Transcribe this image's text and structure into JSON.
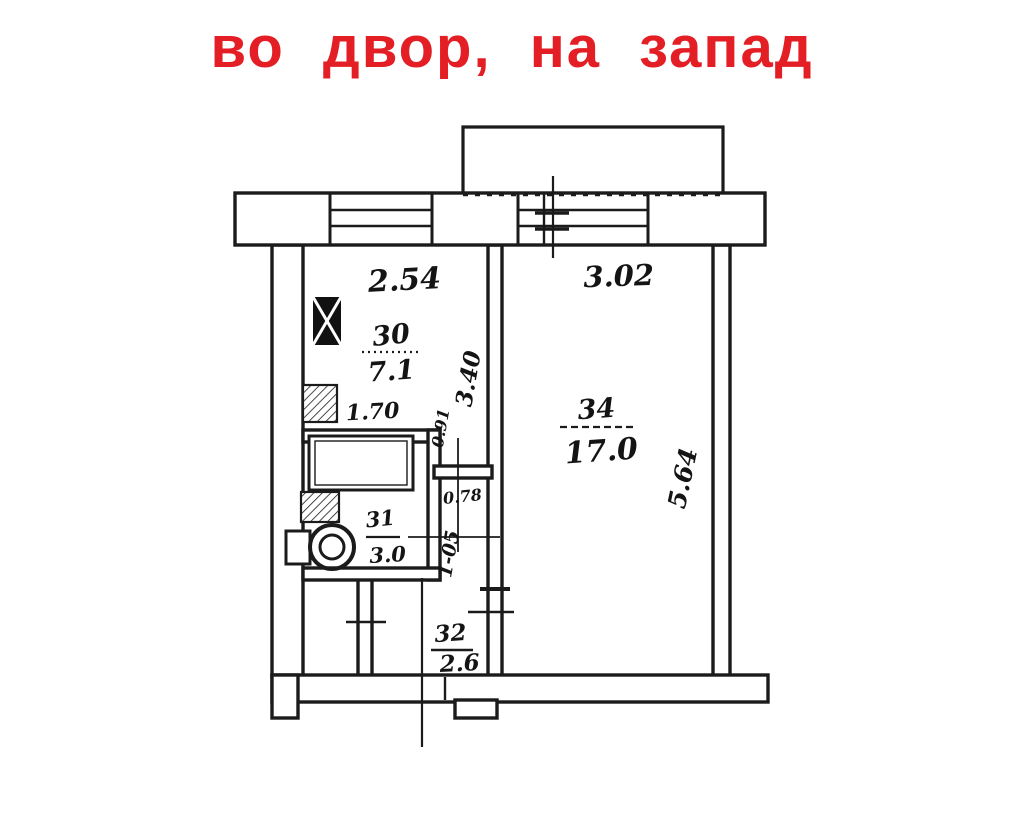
{
  "title": {
    "text": "во двор, на запад",
    "color": "#e31e24"
  },
  "plan": {
    "rooms": [
      {
        "id": "kitchen",
        "number": "30",
        "area": "7.1"
      },
      {
        "id": "bathroom",
        "number": "31",
        "area": "3.0"
      },
      {
        "id": "hall",
        "number": "32",
        "area": "2.6"
      },
      {
        "id": "living-room",
        "number": "34",
        "area": "17.0"
      }
    ],
    "dimensions": {
      "kitchen_width": "2.54",
      "living_width": "3.02",
      "kitchen_inner": "1.70",
      "kitchen_depth": "3.40",
      "wall_small": "0.91",
      "door_width": "0.78",
      "passage": "1-05",
      "living_depth": "5.64"
    }
  },
  "colors": {
    "ink": "#1b1b1b",
    "title_red": "#e31e24",
    "paper": "#ffffff"
  }
}
